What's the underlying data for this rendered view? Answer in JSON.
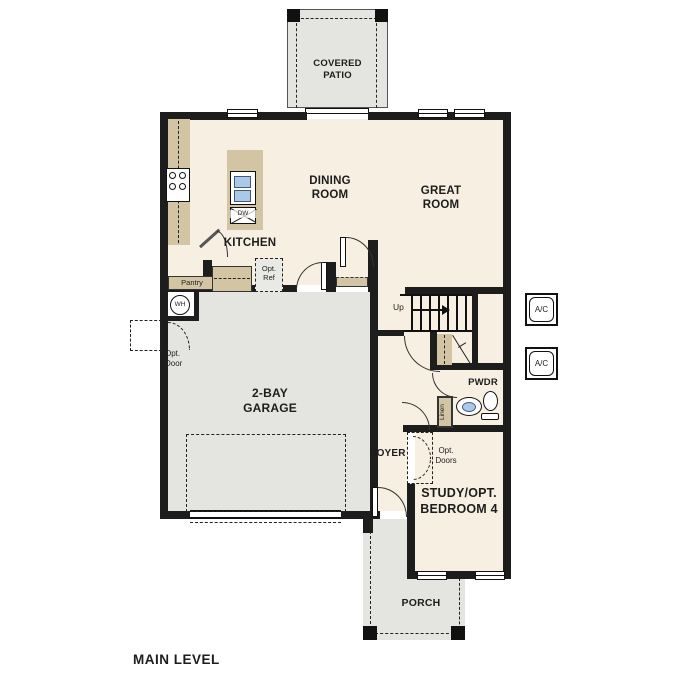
{
  "footer": {
    "title": "MAIN LEVEL"
  },
  "rooms": {
    "covered_patio": {
      "line1": "COVERED",
      "line2": "PATIO"
    },
    "dining_room": {
      "line1": "DINING",
      "line2": "ROOM"
    },
    "great_room": {
      "line1": "GREAT",
      "line2": "ROOM"
    },
    "kitchen": {
      "label": "KITCHEN"
    },
    "garage": {
      "line1": "2-BAY",
      "line2": "GARAGE"
    },
    "powder_room": {
      "label": "PWDR"
    },
    "foyer": {
      "label": "FOYER"
    },
    "study_bedroom": {
      "line1": "STUDY/OPT.",
      "line2": "BEDROOM 4"
    },
    "porch": {
      "label": "PORCH"
    }
  },
  "fixtures": {
    "pantry": "Pantry",
    "opt_ref": {
      "line1": "Opt.",
      "line2": "Ref"
    },
    "water_heater": "WH",
    "opt_door": {
      "line1": "Opt.",
      "line2": "Door"
    },
    "opt_doors": {
      "line1": "Opt.",
      "line2": "Doors"
    },
    "linen": "Linen",
    "stairs_direction": "Up",
    "dishwasher": "DW",
    "ac_top": "A/C",
    "ac_bottom": "A/C"
  },
  "colors": {
    "interior_floor": "#f7efe2",
    "exterior_concrete": "#e4e4e1",
    "cabinetry_tan": "#d3c5a4",
    "wall_black": "#1d1d1d",
    "fixture_blue": "#aac9e9"
  }
}
